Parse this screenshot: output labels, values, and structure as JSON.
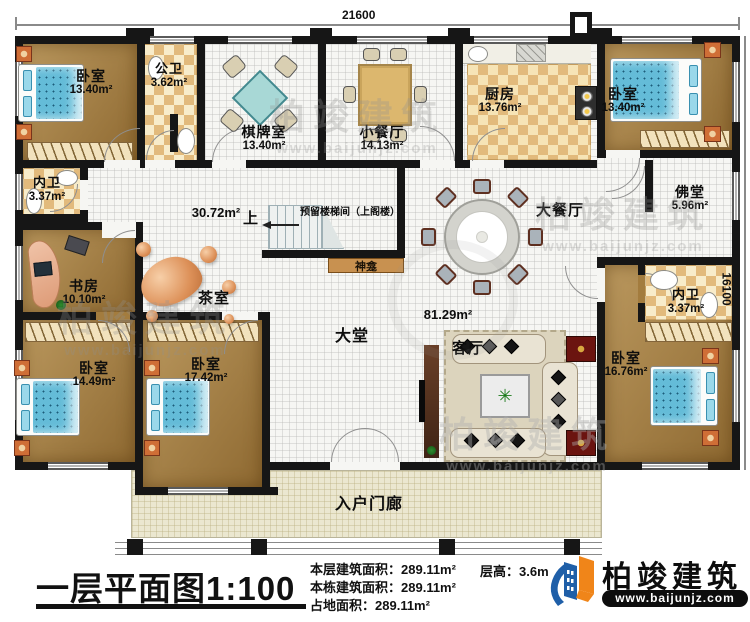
{
  "dimensions": {
    "top": "21600",
    "right": "16100"
  },
  "plan_notes": {
    "up_label": "上",
    "stair_note": "预留楼梯间（上阁楼）"
  },
  "rooms": {
    "bedroom_tl": {
      "label": "卧室",
      "area": "13.40m²"
    },
    "public_bath": {
      "label": "公卫",
      "area": "3.62m²"
    },
    "chess_room": {
      "label": "棋牌室",
      "area": "13.40m²"
    },
    "small_dining": {
      "label": "小餐厅",
      "area": "14.13m²"
    },
    "kitchen": {
      "label": "厨房",
      "area": "13.76m²"
    },
    "bedroom_tr": {
      "label": "卧室",
      "area": "13.40m²"
    },
    "inner_bath_left": {
      "label": "内卫",
      "area": "3.37m²"
    },
    "study": {
      "label": "书房",
      "area": "10.10m²"
    },
    "hall_open": {
      "area": "30.72m²"
    },
    "tea_room": {
      "label": "茶室"
    },
    "shrine": {
      "label": "神龛"
    },
    "grand_dining": {
      "label": "大餐厅"
    },
    "buddha_hall": {
      "label": "佛堂",
      "area": "5.96m²"
    },
    "inner_bath_right": {
      "label": "内卫",
      "area": "3.37m²"
    },
    "bedroom_bl": {
      "label": "卧室",
      "area": "14.49m²"
    },
    "bedroom_bc": {
      "label": "卧室",
      "area": "17.42m²"
    },
    "lobby": {
      "label": "大堂"
    },
    "living_room": {
      "label": "客厅",
      "area": "81.29m²"
    },
    "bedroom_br": {
      "label": "卧室",
      "area": "16.76m²"
    },
    "porch": {
      "label": "入户门廊"
    }
  },
  "footer": {
    "title": "一层平面图1:100",
    "stats": [
      {
        "label": "本层建筑面积：",
        "value": "289.11m²"
      },
      {
        "label": "本栋建筑面积：",
        "value": "289.11m²"
      },
      {
        "label": "占地面积：",
        "value": "289.11m²"
      }
    ],
    "floor_height_label": "层高：",
    "floor_height_value": "3.6m",
    "brand": "柏竣建筑",
    "brand_url": "www.baijunjz.com"
  },
  "watermark": {
    "text": "柏竣建筑",
    "url": "www.baijunjz.com"
  },
  "colors": {
    "accent_orange": "#f08519",
    "accent_blue": "#1f5fa8",
    "wall": "#161616"
  }
}
